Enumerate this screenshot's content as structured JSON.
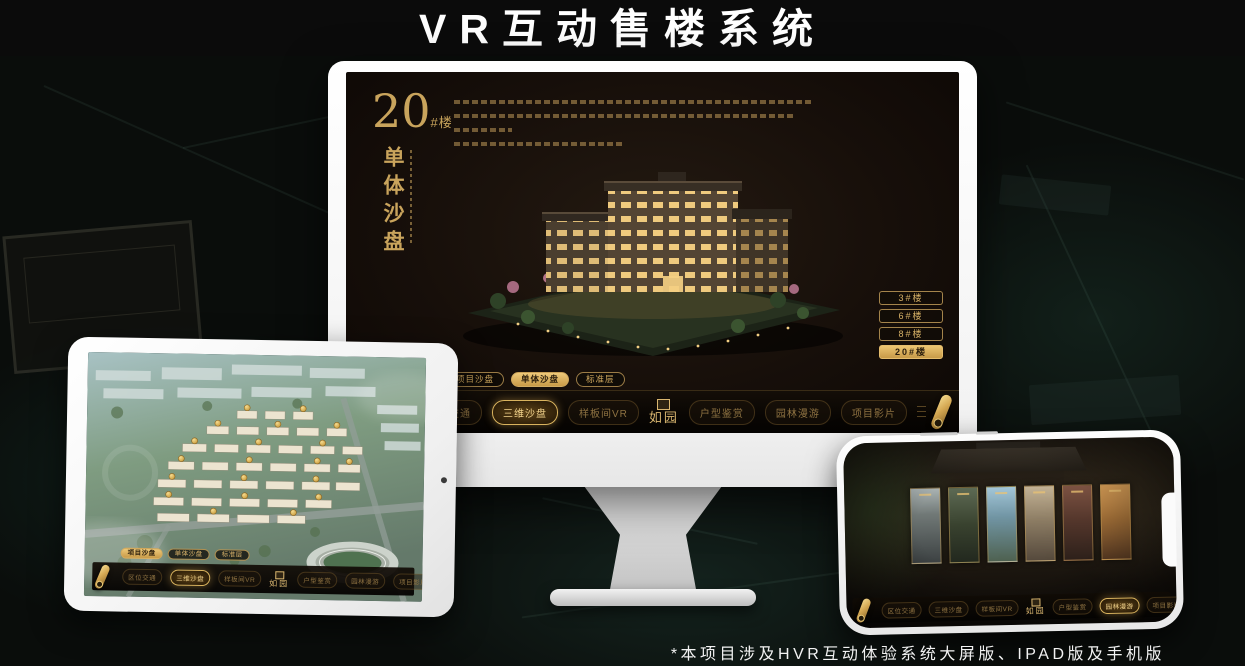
{
  "page": {
    "title": "VR互动售楼系统",
    "footnote": "*本项目涉及HVR互动体验系统大屏版、IPAD版及手机版"
  },
  "colors": {
    "gold_accent": "#c9a45c",
    "gold_bright": "#ecc878",
    "screen_background": "#17110b"
  },
  "monitor": {
    "block_number": "20",
    "block_suffix": "#楼",
    "panel_title": "单体沙盘",
    "building_buttons": [
      "3#楼",
      "6#楼",
      "8#楼",
      "20#楼"
    ],
    "active_building_button": "20#楼",
    "sub_tabs": [
      "项目沙盘",
      "单体沙盘",
      "标准层"
    ],
    "active_sub_tab": "单体沙盘",
    "nav_items": [
      "区位交通",
      "三维沙盘",
      "样板间VR",
      "户型鉴赏",
      "园林漫游",
      "项目影片"
    ],
    "active_nav_item": "三维沙盘",
    "logo": "如园",
    "icons": [
      "scroll-icon"
    ]
  },
  "tablet": {
    "sub_tabs": [
      "项目沙盘",
      "单体沙盘",
      "标准层"
    ],
    "active_sub_tab": "项目沙盘",
    "nav_items": [
      "区位交通",
      "三维沙盘",
      "样板间VR",
      "户型鉴赏",
      "园林漫游",
      "项目影片"
    ],
    "active_nav_item": "三维沙盘",
    "logo": "如园",
    "icons": [
      "scroll-icon",
      "scroll-icon"
    ]
  },
  "phone": {
    "nav_items": [
      "区位交通",
      "三维沙盘",
      "样板间VR",
      "户型鉴赏",
      "园林漫游",
      "项目影片"
    ],
    "active_nav_item": "园林漫游",
    "logo": "如园",
    "icons": [
      "scroll-icon",
      "scroll-icon"
    ]
  }
}
